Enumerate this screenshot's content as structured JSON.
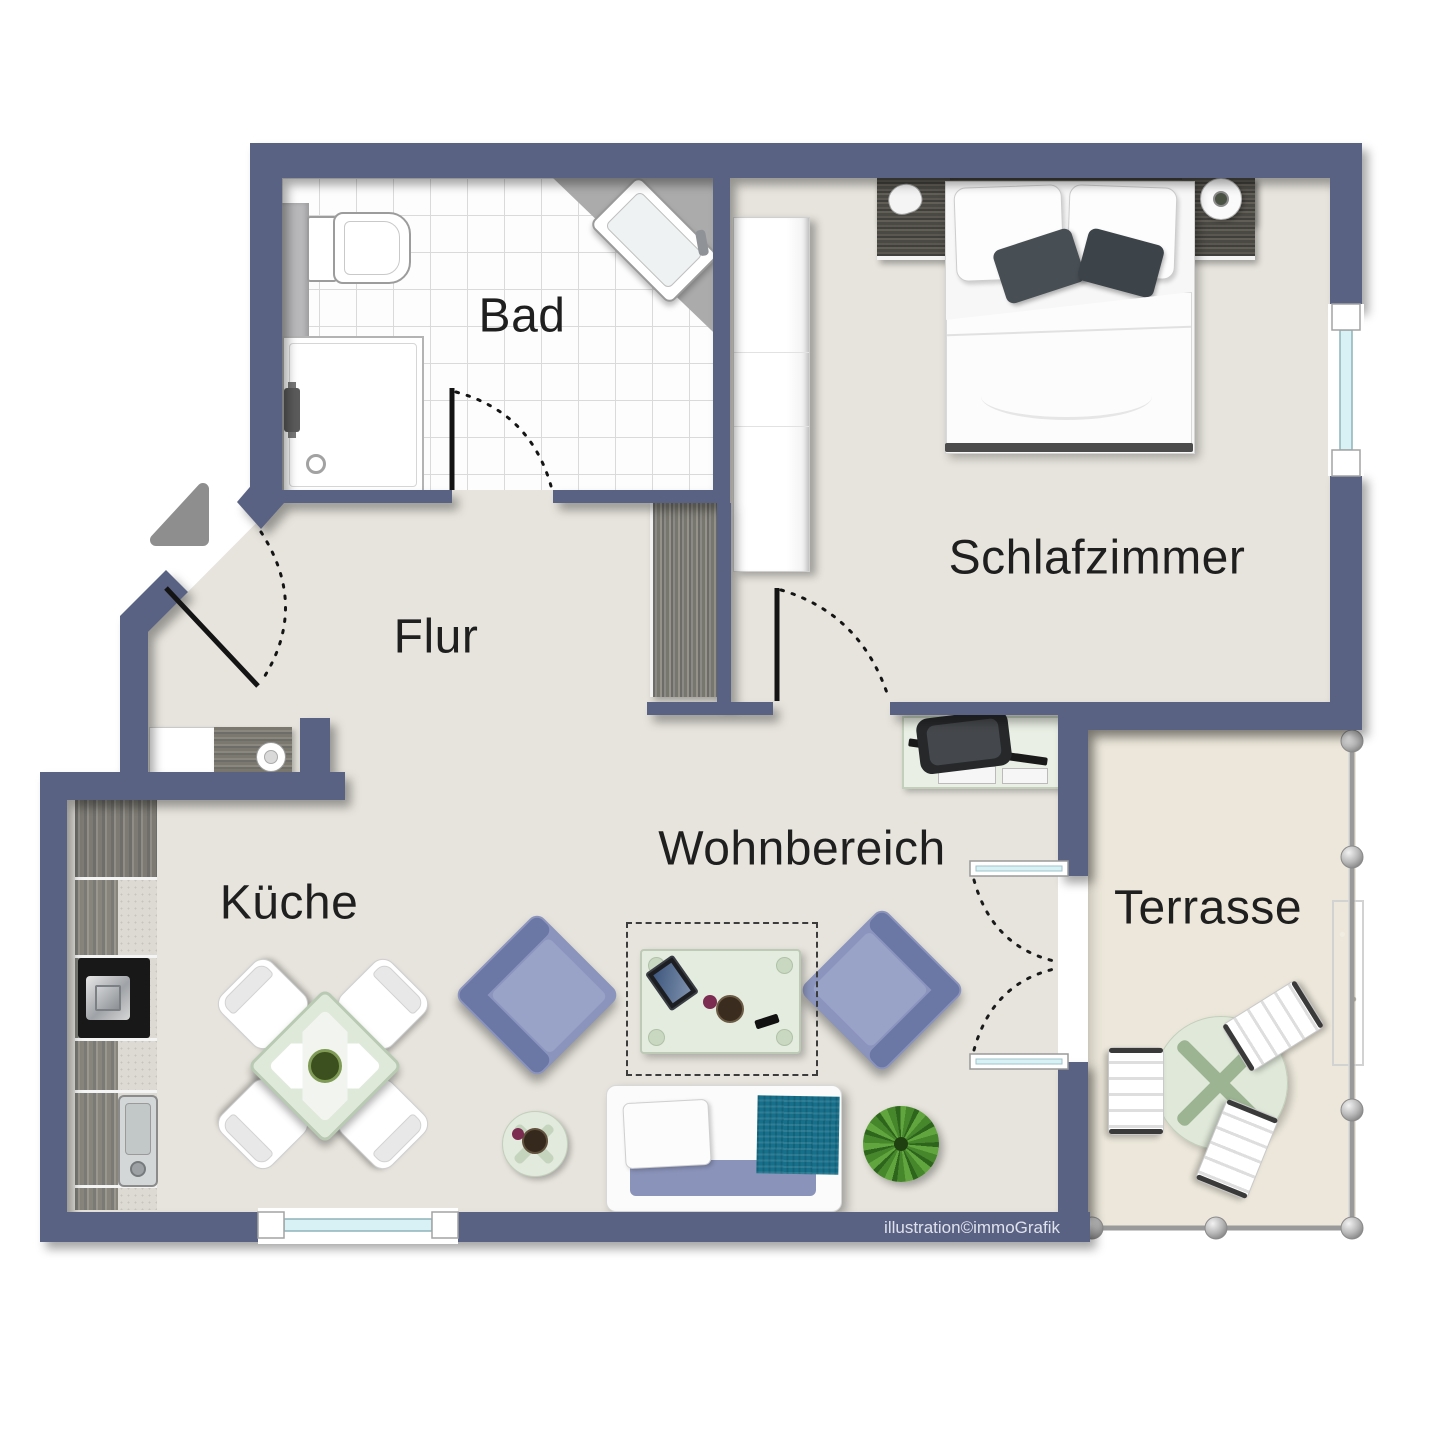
{
  "title": "Apartment floor plan",
  "credit": "illustration©immoGrafik",
  "rooms": {
    "bad": {
      "label": "Bad"
    },
    "schlafzimmer": {
      "label": "Schlafzimmer"
    },
    "flur": {
      "label": "Flur"
    },
    "kueche": {
      "label": "Küche"
    },
    "wohnbereich": {
      "label": "Wohnbereich"
    },
    "terrasse": {
      "label": "Terrasse"
    }
  },
  "palette": {
    "wall": "#5a6283",
    "floor_interior": "#e7e4dd",
    "floor_terrace": "#ece7da",
    "bath_tile": "#fdfdfd",
    "upholstery_blue": "#8b94bd",
    "blanket_teal": "#17708a",
    "window_glass": "#d8f1f5",
    "plant_green": "#47872c",
    "label_text": "#1f1f1f"
  }
}
